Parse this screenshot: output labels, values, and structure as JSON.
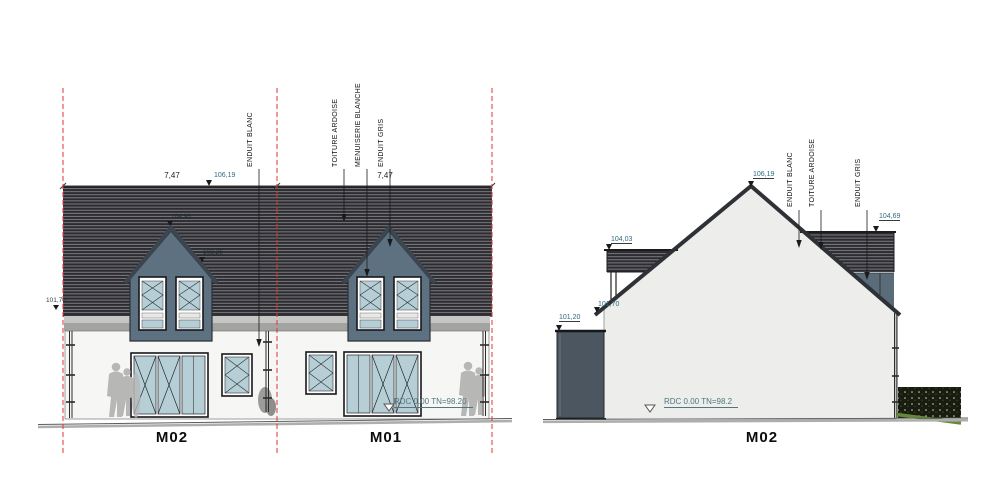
{
  "front": {
    "callouts": {
      "enduit_blanc": "ENDUIT BLANC",
      "toiture_ardoise": "TOITURE ARDOISE",
      "menuiserie_blanche": "MENUISERIE BLANCHE",
      "enduit_gris": "ENDUIT GRIS"
    },
    "dim_left": "7,47",
    "dim_right": "7,47",
    "ridge_level": "106,19",
    "eaves_level": "101,70",
    "dormer_peak_level": "104,96",
    "dormer_base_level": "103,26",
    "rdc_note": "RDC 0.00 TN=98.20",
    "unit_left": "M02",
    "unit_right": "M01"
  },
  "side": {
    "callouts": {
      "enduit_blanc": "ENDUIT BLANC",
      "toiture_ardoise": "TOITURE ARDOISE",
      "enduit_gris": "ENDUIT GRIS"
    },
    "ridge_level": "106,19",
    "flat_roof_left_level": "104,03",
    "flat_roof_right_level": "104,69",
    "eaves_level": "101,70",
    "annex_level": "101,20",
    "rdc_note": "RDC 0.00 TN=98.2",
    "unit_label": "M02"
  },
  "colors": {
    "roof_slate": "#2c2c30",
    "dormer_grey": "#5d7181",
    "glass_blue": "#b6cfd7",
    "wall_white": "#f6f6f4",
    "gable_fill": "#ededeb",
    "annex_grey": "#4b5660",
    "level_teal": "#2f6b7a",
    "axis_red": "#e03434",
    "figure_grey": "#b7b7b5",
    "hedge_dark": "#181d10",
    "grass_green": "#678a39"
  }
}
